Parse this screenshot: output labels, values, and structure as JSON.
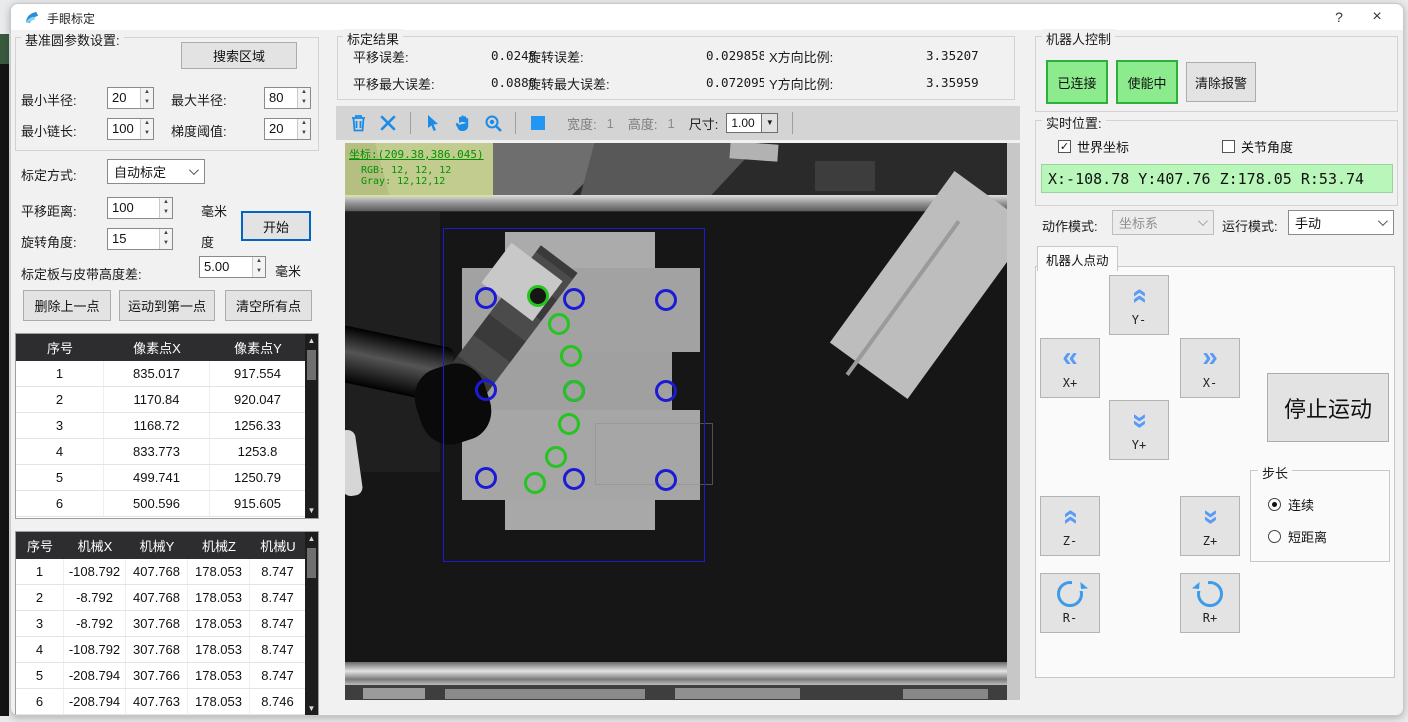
{
  "window": {
    "title": "手眼标定",
    "help": "?",
    "close": "×"
  },
  "left_panel": {
    "group_title": "基准圆参数设置:",
    "search_button": "搜索区域",
    "min_radius_label": "最小半径:",
    "min_radius": "20",
    "max_radius_label": "最大半径:",
    "max_radius": "80",
    "min_chain_label": "最小链长:",
    "min_chain": "100",
    "gradient_label": "梯度阈值:",
    "gradient": "20",
    "calib_mode_label": "标定方式:",
    "calib_mode": "自动标定",
    "translate_label": "平移距离:",
    "translate": "100",
    "translate_unit": "毫米",
    "rotate_label": "旋转角度:",
    "rotate": "15",
    "rotate_unit": "度",
    "start_button": "开始",
    "height_diff_label": "标定板与皮带高度差:",
    "height_diff": "5.00",
    "height_diff_unit": "毫米",
    "delete_last_button": "删除上一点",
    "move_first_button": "运动到第一点",
    "clear_all_button": "清空所有点",
    "pixel_table": {
      "headers": [
        "序号",
        "像素点X",
        "像素点Y"
      ],
      "rows": [
        [
          "1",
          "835.017",
          "917.554"
        ],
        [
          "2",
          "1170.84",
          "920.047"
        ],
        [
          "3",
          "1168.72",
          "1256.33"
        ],
        [
          "4",
          "833.773",
          "1253.8"
        ],
        [
          "5",
          "499.741",
          "1250.79"
        ],
        [
          "6",
          "500.596",
          "915.605"
        ]
      ]
    },
    "robot_table": {
      "headers": [
        "序号",
        "机械X",
        "机械Y",
        "机械Z",
        "机械U"
      ],
      "rows": [
        [
          "1",
          "-108.792",
          "407.768",
          "178.053",
          "8.747"
        ],
        [
          "2",
          "-8.792",
          "407.768",
          "178.053",
          "8.747"
        ],
        [
          "3",
          "-8.792",
          "307.768",
          "178.053",
          "8.747"
        ],
        [
          "4",
          "-108.792",
          "307.768",
          "178.053",
          "8.747"
        ],
        [
          "5",
          "-208.794",
          "307.766",
          "178.053",
          "8.747"
        ],
        [
          "6",
          "-208.794",
          "407.763",
          "178.053",
          "8.746"
        ]
      ]
    }
  },
  "results": {
    "group_title": "标定结果",
    "trans_err_label": "平移误差:",
    "trans_err": "0.02489",
    "rot_err_label": "旋转误差:",
    "rot_err": "0.029858",
    "x_scale_label": "X方向比例:",
    "x_scale": "3.35207",
    "trans_max_err_label": "平移最大误差:",
    "trans_max_err": "0.08800",
    "rot_max_err_label": "旋转最大误差:",
    "rot_max_err": "0.072095",
    "y_scale_label": "Y方向比例:",
    "y_scale": "3.35959"
  },
  "toolbar": {
    "icons": [
      "trash-icon",
      "close-icon",
      "cursor-icon",
      "pan-hand-icon",
      "zoom-icon",
      "rect-select-icon"
    ],
    "width_label": "宽度:",
    "width_value": "1",
    "height_label": "高度:",
    "height_value": "1",
    "size_label": "尺寸:",
    "size_value": "1.00"
  },
  "viewer": {
    "overlay_coord": "坐标:(209.38,386.045)",
    "overlay_rgb": "RGB: 12, 12, 12",
    "overlay_gray": "Gray: 12,12,12",
    "blue_circles": [
      [
        141,
        155
      ],
      [
        229,
        156
      ],
      [
        321,
        157
      ],
      [
        141,
        247
      ],
      [
        229,
        248
      ],
      [
        321,
        248
      ],
      [
        141,
        335
      ],
      [
        229,
        336
      ],
      [
        321,
        337
      ]
    ],
    "green_circles": [
      [
        193,
        153
      ],
      [
        214,
        181
      ],
      [
        226,
        213
      ],
      [
        229,
        248
      ],
      [
        224,
        281
      ],
      [
        211,
        314
      ],
      [
        190,
        340
      ]
    ]
  },
  "right_panel": {
    "group_title": "机器人控制",
    "connected_button": "已连接",
    "enabled_button": "使能中",
    "clear_alarm_button": "清除报警",
    "realtime_title": "实时位置:",
    "world_coord_label": "世界坐标",
    "joint_angle_label": "关节角度",
    "position_value": "X:-108.78 Y:407.76 Z:178.05 R:53.74",
    "action_mode_label": "动作模式:",
    "action_mode": "坐标系",
    "run_mode_label": "运行模式:",
    "run_mode": "手动",
    "jog_tab": "机器人点动",
    "jog": {
      "y_minus": "Y-",
      "x_plus": "X+",
      "x_minus": "X-",
      "y_plus": "Y+",
      "z_minus": "Z-",
      "z_plus": "Z+",
      "r_minus": "R-",
      "r_plus": "R+"
    },
    "stop_button": "停止运动",
    "step_group": "步长",
    "step_continuous": "连续",
    "step_short": "短距离"
  },
  "colors": {
    "toolbar_icon_blue": "#1a8ce8",
    "circle_blue": "#1b1bd6",
    "circle_green": "#25c41f",
    "connected_green_bg": "#8ceb8c",
    "position_bg": "#b9f6b9",
    "overlay_bg": "#d7e29b",
    "header_dark": "#2d2d30"
  }
}
